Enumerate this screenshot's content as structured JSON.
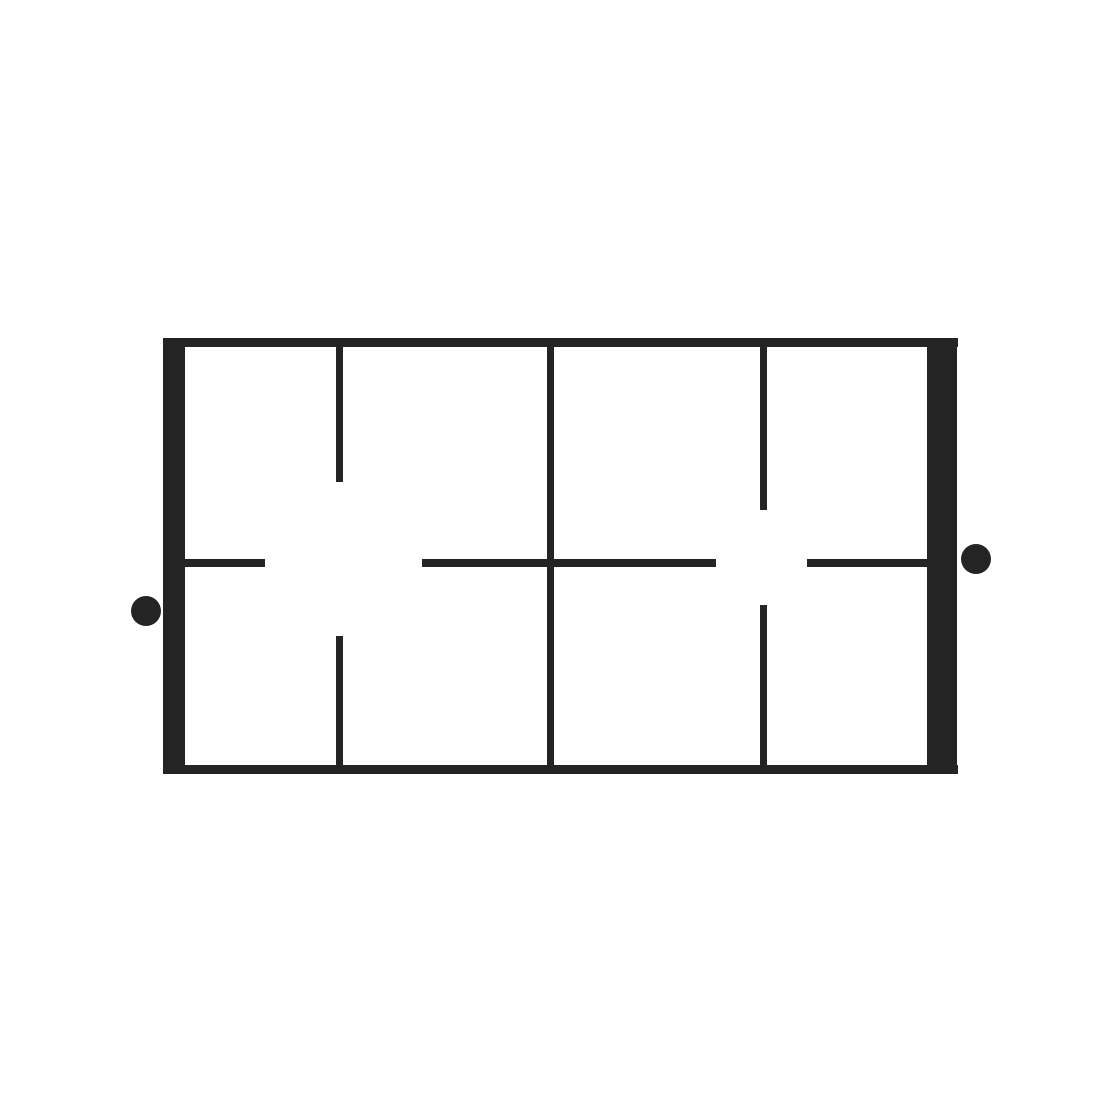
{
  "figure": {
    "description": "Black line drawing of a horizontal rectangular frame with thick vertical end bars, three internal vertical divider lines (the left and right dividers broken by central gaps, the middle divider continuous), a broken horizontal midline, and two solid black dots outside the frame on the left and right sides",
    "background": "#ffffff",
    "ink": "#242424",
    "canvas": {
      "width": 1100,
      "height": 1100
    },
    "elements": [
      {
        "name": "frame-top-edge",
        "type": "rect",
        "x": 163,
        "y": 338,
        "w": 795,
        "h": 9
      },
      {
        "name": "frame-bottom-edge",
        "type": "rect",
        "x": 163,
        "y": 765,
        "w": 795,
        "h": 9
      },
      {
        "name": "frame-left-end-bar",
        "type": "rect",
        "x": 163,
        "y": 338,
        "w": 22,
        "h": 436
      },
      {
        "name": "frame-right-end-bar",
        "type": "rect",
        "x": 927,
        "y": 338,
        "w": 30,
        "h": 436
      },
      {
        "name": "left-divider-top-segment",
        "type": "rect",
        "x": 336,
        "y": 347,
        "w": 7,
        "h": 135
      },
      {
        "name": "left-divider-bottom-segment",
        "type": "rect",
        "x": 336,
        "y": 636,
        "w": 7,
        "h": 129
      },
      {
        "name": "center-divider",
        "type": "rect",
        "x": 547,
        "y": 347,
        "w": 7,
        "h": 418
      },
      {
        "name": "right-divider-top-segment",
        "type": "rect",
        "x": 760,
        "y": 347,
        "w": 7,
        "h": 163
      },
      {
        "name": "right-divider-bottom-segment",
        "type": "rect",
        "x": 760,
        "y": 605,
        "w": 7,
        "h": 160
      },
      {
        "name": "midline-left-stub",
        "type": "rect",
        "x": 185,
        "y": 559,
        "w": 80,
        "h": 8
      },
      {
        "name": "midline-center-segment",
        "type": "rect",
        "x": 422,
        "y": 559,
        "w": 294,
        "h": 8
      },
      {
        "name": "midline-right-segment",
        "type": "rect",
        "x": 807,
        "y": 559,
        "w": 120,
        "h": 8
      },
      {
        "name": "left-dot",
        "type": "circle",
        "cx": 146,
        "cy": 611,
        "r": 15
      },
      {
        "name": "right-dot",
        "type": "circle",
        "cx": 976,
        "cy": 559,
        "r": 15
      }
    ]
  }
}
